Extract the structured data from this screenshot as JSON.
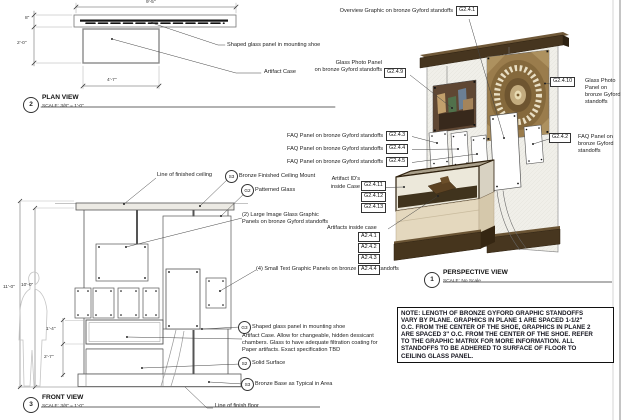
{
  "plan_view": {
    "number": "2",
    "title": "PLAN VIEW",
    "scale": "SCALE: 3/8\" = 1'-0\"",
    "dims": {
      "overall_width": "9'-5\"",
      "shoe_depth": "8\"",
      "case_depth": "2'-0\"",
      "case_width": "4'-7\""
    },
    "labels": {
      "shoe": "Shaped glass panel in mounting shoe",
      "case": "Artifact Case"
    }
  },
  "front_view": {
    "number": "3",
    "title": "FRONT VIEW",
    "scale": "SCALE: 3/8\" = 1'-0\"",
    "dims": {
      "overall_height": "11'-0\"",
      "glass_height": "10'-0\"",
      "case_glass_height": "1'-4\"",
      "case_base_height": "2'-7\""
    },
    "callouts": {
      "ceiling_line": "Line of finished ceiling",
      "ceiling_mount_tag": "S3",
      "ceiling_mount": "Bronze Finished Ceiling Mount",
      "patterned_glass_tag": "G2",
      "patterned_glass": "Patterned Glass",
      "large_panels_line1": "(2) Large Image Glass Graphic",
      "large_panels_line2": "Panels on bronze Gyford standoffs",
      "small_panels": "(4) Small Text Graphic Panels on bronze Gyford standoffs",
      "shaped_glass_tag": "G3",
      "shaped_glass": "Shaped glass panel in mounting shoe",
      "case_note_line1": "Artifact Case. Allow for changeable, hidden dessicant",
      "case_note_line2": "chambers. Glass to have adequate filtration coating for",
      "case_note_line3": "Paper artifacts. Exact specification TBD",
      "solid_surface_tag": "S2",
      "solid_surface": "Solid Surface",
      "bronze_base_tag": "S3",
      "bronze_base": "Bronze Base as Typical in Area",
      "floor_line": "Line of finish floor"
    }
  },
  "perspective_view": {
    "number": "1",
    "title": "PERSPECTIVE VIEW",
    "scale": "SCALE: No Scale",
    "callouts": {
      "overview": "Overview Graphic on bronze Gyford standoffs",
      "overview_tag": "G2.4.1",
      "photo_left_line1": "Glass Photo Panel",
      "photo_left_line2": "on bronze Gyford standoffs",
      "photo_left_tag": "G2.4.9",
      "photo_right_tag": "G2.4.10",
      "photo_right_line1": "Glass Photo",
      "photo_right_line2": "Panel on",
      "photo_right_line3": "bronze Gyford",
      "photo_right_line4": "standoffs",
      "faq": "FAQ Panel on bronze Gyford standoffs",
      "faq_tag1": "G2.4.3",
      "faq_tag2": "G2.4.4",
      "faq_tag3": "G2.4.5",
      "faq_right_tag": "G2.4.2",
      "faq_right_line1": "FAQ Panel on",
      "faq_right_line2": "bronze Gyford",
      "faq_right_line3": "standoffs",
      "artifact_ids_line1": "Artifact ID's",
      "artifact_ids_line2": "inside Case",
      "artifact_id_tag1": "G2.4.11",
      "artifact_id_tag2": "G2.4.12",
      "artifact_id_tag3": "G2.4.13",
      "artifacts": "Artifacts inside case",
      "artifact_tag1": "A2.4.1",
      "artifact_tag2": "A2.4.2",
      "artifact_tag3": "A2.4.3",
      "artifact_tag4": "A2.4.4"
    }
  },
  "note": {
    "line1": "NOTE: LENGTH OF BRONZE GYFORD GRAPHIC STANDOFFS",
    "line2": "VARY BY PLANE. GRAPHICS IN PLANE 1 ARE SPACED 1-1/2\"",
    "line3": "O.C. FROM THE CENTER OF THE SHOE, GRAPHICS IN PLANE 2",
    "line4": "ARE SPACED 3\" O.C. FROM THE CENTER OF THE SHOE. REFER",
    "line5": "TO THE GRAPHIC MATRIX FOR MORE INFORMATION. ALL",
    "line6": "STANDOFFS TO BE ADHERED TO SURFACE OF FLOOR TO",
    "line7": "CEILING GLASS PANEL.",
    "colors": {
      "bronze": "#46351f",
      "tan_base": "#e4d8be",
      "dome_gold": "#9a7c4c",
      "glass_wall": "#f0efe9"
    }
  }
}
